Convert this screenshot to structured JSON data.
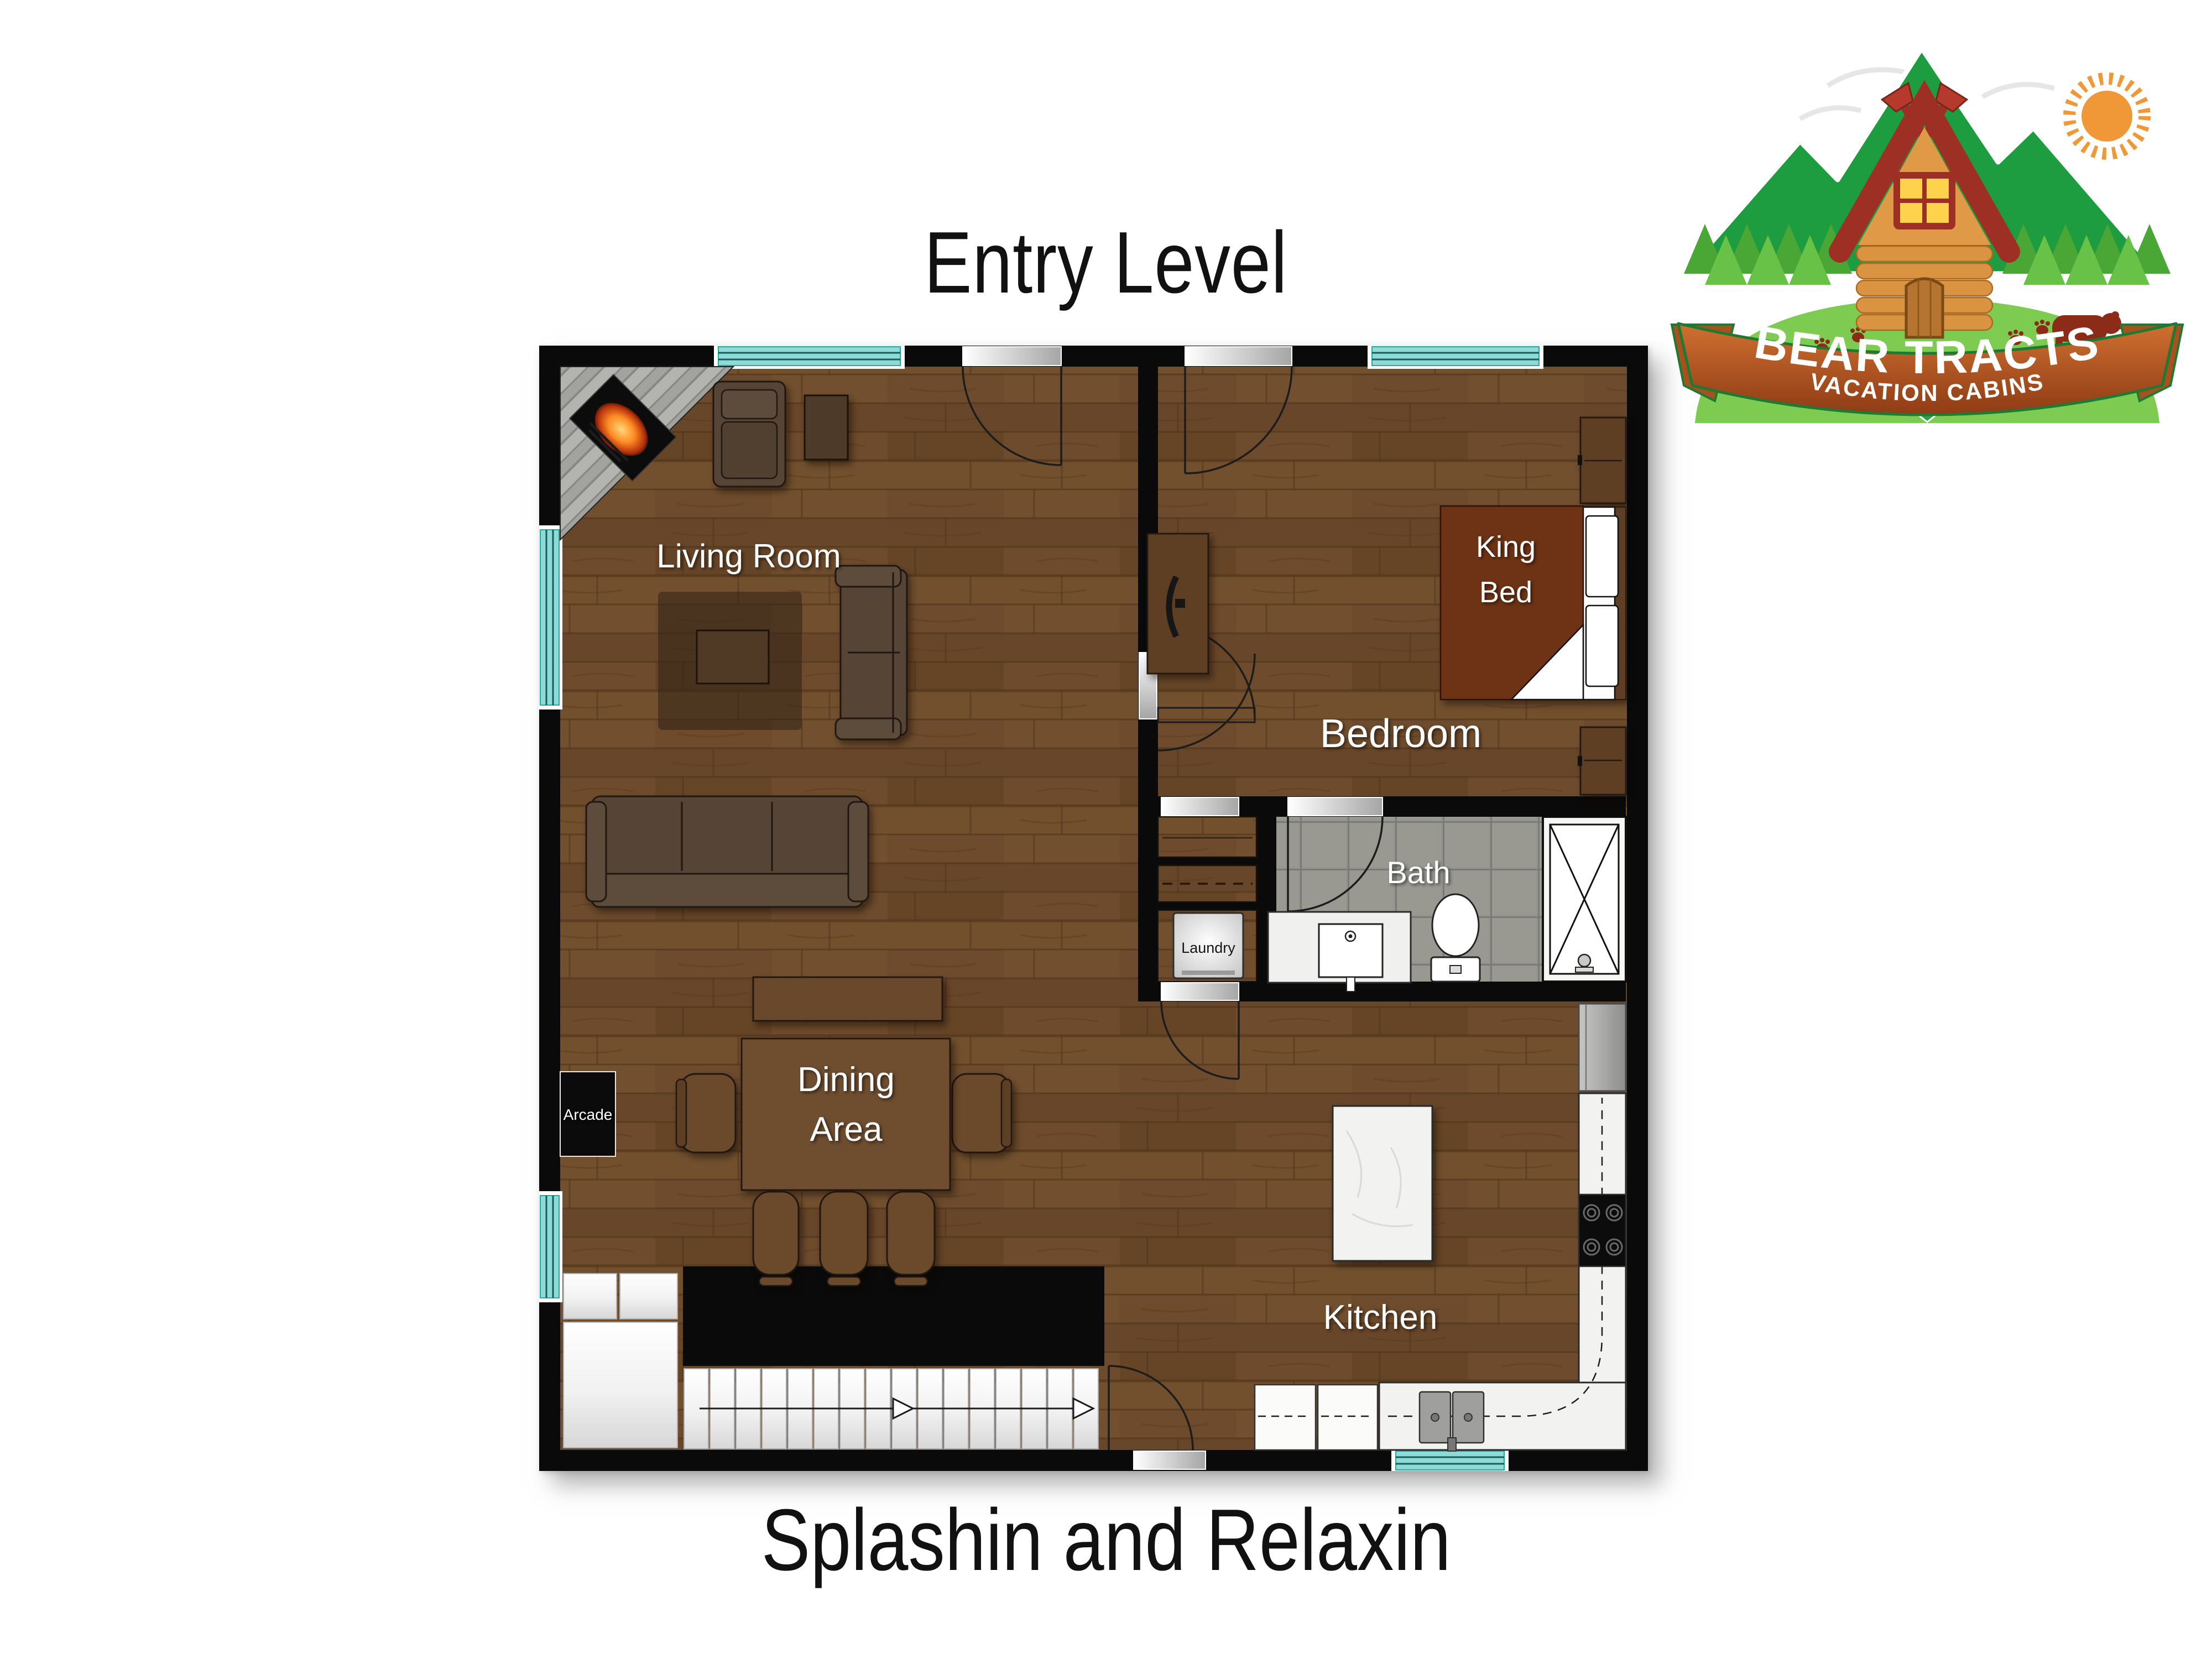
{
  "page": {
    "title": "Entry Level",
    "caption": "Splashin and Relaxin",
    "background_color": "#ffffff",
    "title_color": "#111111"
  },
  "logo": {
    "name": "BEAR TRACTS",
    "tagline": "VACATION CABINS",
    "banner_color": "#b4551f",
    "banner_edge_color": "#1d7a33",
    "mountain_color": "#1e9c40",
    "tree_color": "#5ab53b",
    "hill_color": "#7ecb52",
    "sun_color": "#f09737",
    "bear_color": "#8c2c18",
    "cabin_log_color": "#d99341",
    "roof_color": "#9e2f24"
  },
  "floor_plan": {
    "level_name": "Entry Level",
    "labels": {
      "living_room": "Living Room",
      "bedroom": "Bedroom",
      "king_bed_lines": [
        "King",
        "Bed"
      ],
      "bath": "Bath",
      "laundry": "Laundry",
      "dining_lines": [
        "Dining",
        "Area"
      ],
      "kitchen": "Kitchen",
      "arcade": "Arcade"
    },
    "colors": {
      "wall": "#0a0a0a",
      "wood_floor": "#6d4b2c",
      "window_teal": "#8fd9d6",
      "bath_tile": "#95958f",
      "bed_blanket": "#6e3315",
      "counter_marble": "#f2f2f0",
      "stair_tread": "#f5f5f5"
    }
  }
}
